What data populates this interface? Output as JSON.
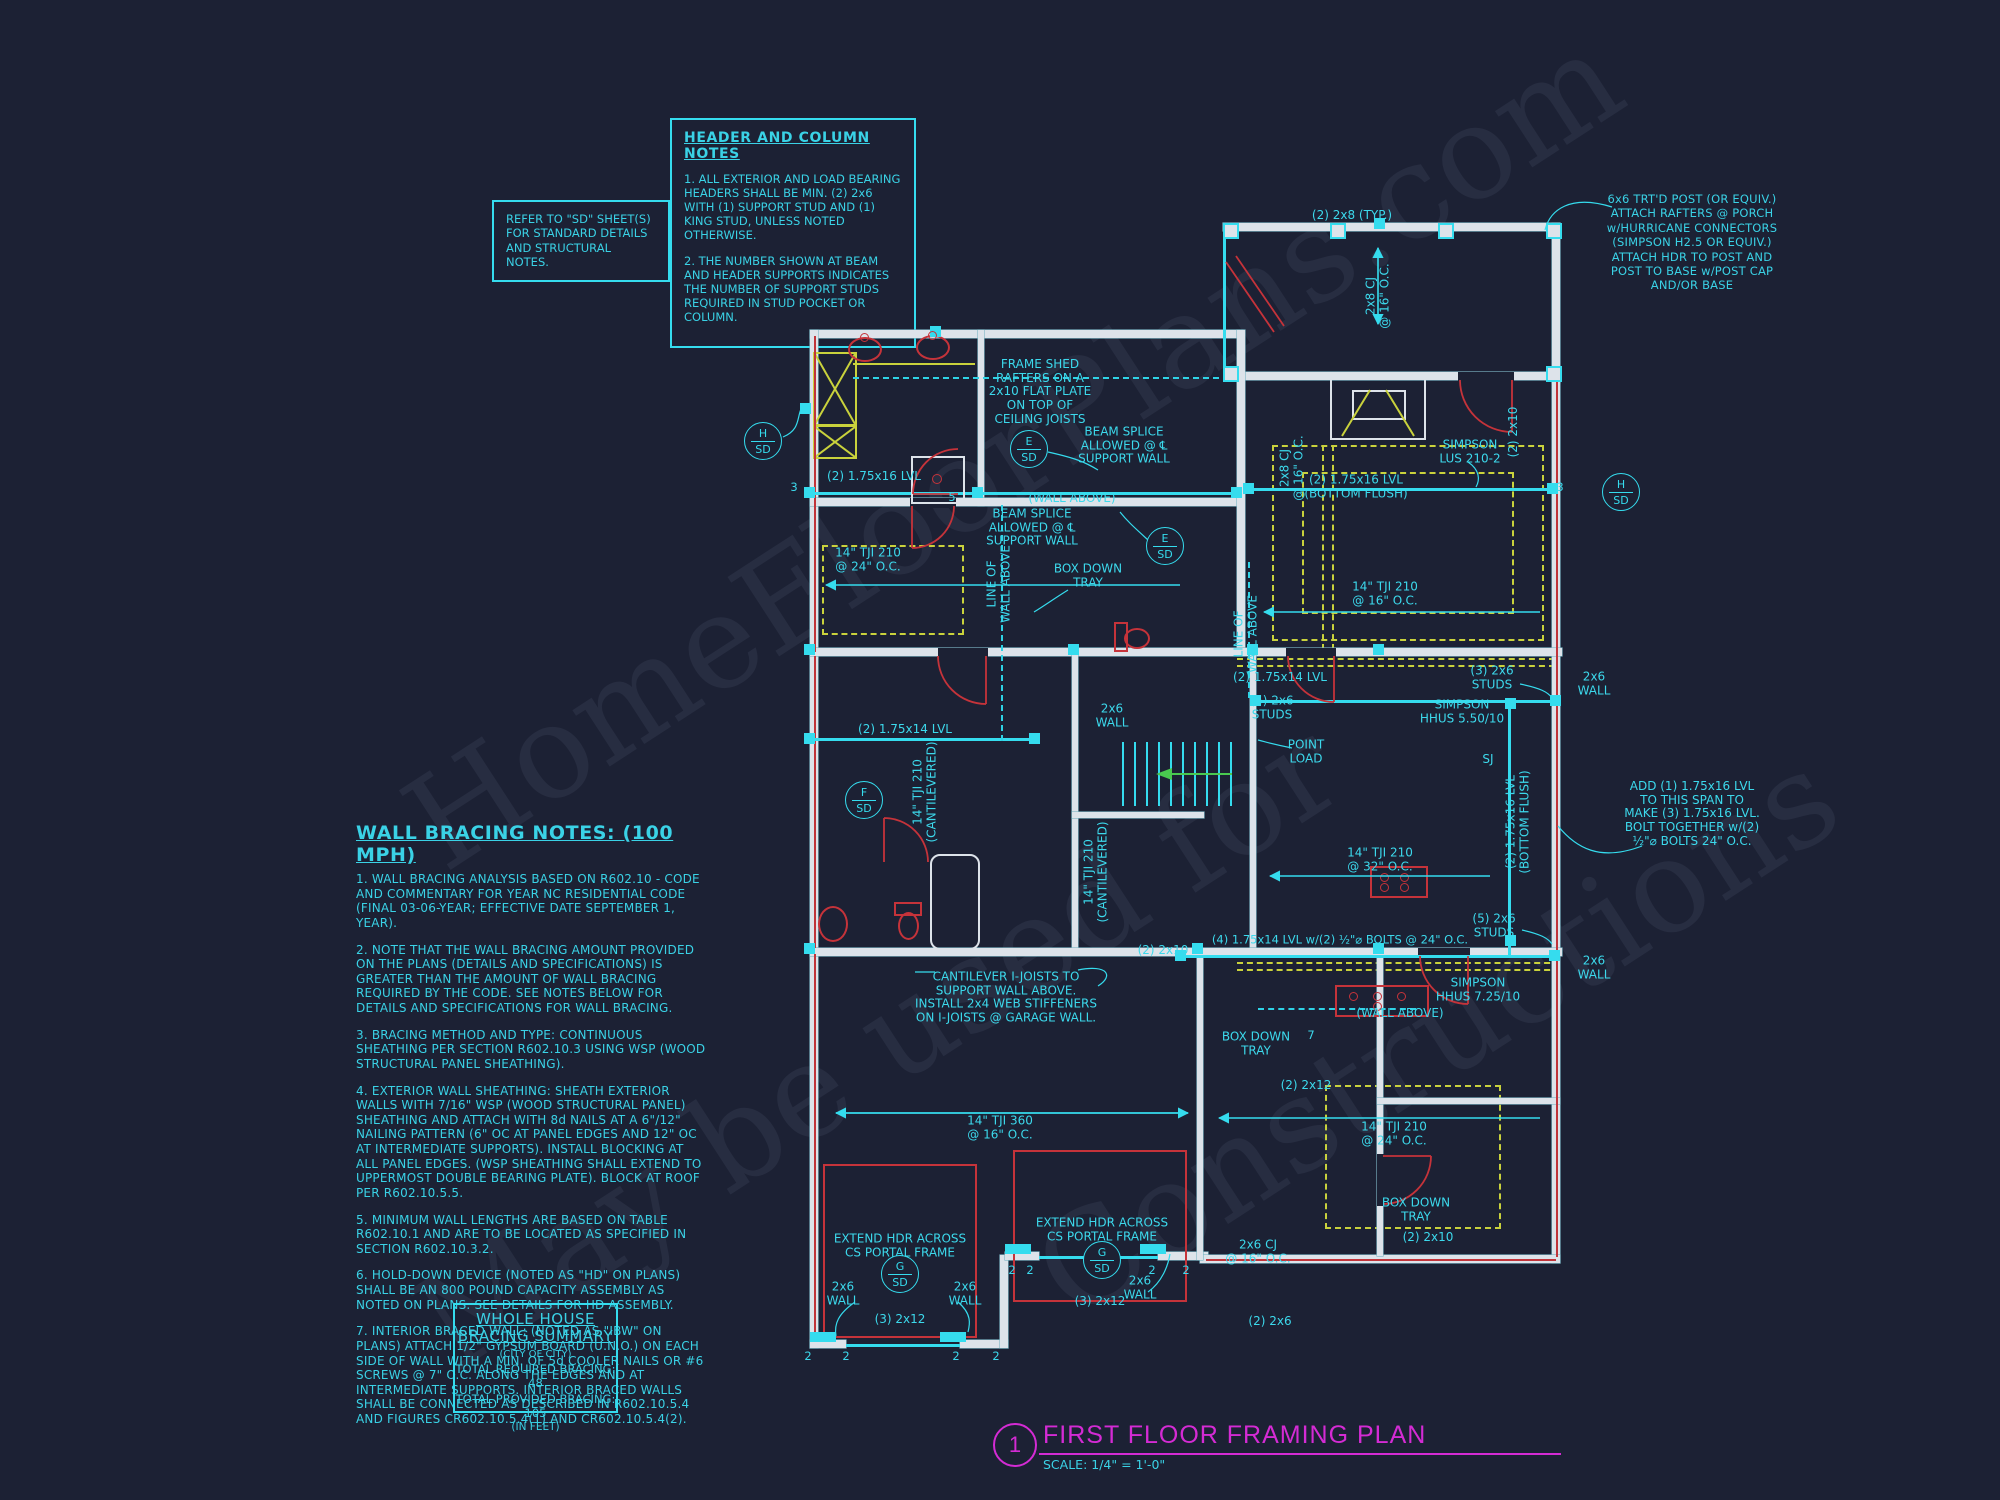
{
  "colors": {
    "background": "#1c2134",
    "cyan": "#35dcee",
    "yellow": "#c9d23c",
    "red": "#c5333a",
    "white_wall": "#dde3ea",
    "magenta": "#d42bd4"
  },
  "watermark": [
    "HomeFloorPlans.com",
    "May be used for",
    "Constructions"
  ],
  "notes": {
    "refer_box": "REFER TO \"SD\" SHEET(S)\nFOR STANDARD DETAILS\nAND STRUCTURAL NOTES.",
    "header_notes": {
      "title": "HEADER AND COLUMN NOTES",
      "items": [
        "1. ALL EXTERIOR AND LOAD BEARING HEADERS SHALL BE MIN. (2) 2x6 WITH (1) SUPPORT STUD AND (1) KING STUD, UNLESS NOTED OTHERWISE.",
        "2. THE NUMBER SHOWN AT BEAM AND HEADER SUPPORTS INDICATES THE NUMBER OF SUPPORT STUDS REQUIRED IN STUD POCKET OR COLUMN."
      ]
    },
    "post_note": "6x6 TRT'D POST (OR EQUIV.)\nATTACH RAFTERS @ PORCH\nw/HURRICANE CONNECTORS\n(SIMPSON H2.5 OR EQUIV.)\nATTACH HDR TO POST AND\nPOST TO BASE w/POST CAP\nAND/OR BASE",
    "wall_bracing": {
      "title": "WALL BRACING NOTES: (100 MPH)",
      "items": [
        "1. WALL BRACING ANALYSIS BASED ON R602.10 - CODE AND COMMENTARY FOR YEAR NC RESIDENTIAL CODE (FINAL 03-06-YEAR; EFFECTIVE DATE SEPTEMBER 1, YEAR).",
        "2. NOTE THAT THE WALL BRACING AMOUNT PROVIDED ON THE PLANS (DETAILS AND SPECIFICATIONS) IS GREATER THAN THE AMOUNT OF WALL BRACING REQUIRED BY THE CODE. SEE NOTES BELOW FOR DETAILS AND SPECIFICATIONS FOR WALL BRACING.",
        "3. BRACING METHOD AND TYPE: CONTINUOUS SHEATHING PER SECTION R602.10.3 USING WSP (WOOD STRUCTURAL PANEL SHEATHING).",
        "4. EXTERIOR WALL SHEATHING: SHEATH EXTERIOR WALLS WITH 7/16\" WSP (WOOD STRUCTURAL PANEL) SHEATHING AND ATTACH WITH 8d NAILS AT A 6\"/12\" NAILING PATTERN (6\" OC AT PANEL EDGES AND 12\" OC AT INTERMEDIATE SUPPORTS). INSTALL BLOCKING AT ALL PANEL EDGES. (WSP SHEATHING SHALL EXTEND TO UPPERMOST DOUBLE BEARING PLATE). BLOCK AT ROOF PER R602.10.5.5.",
        "5. MINIMUM WALL LENGTHS ARE BASED ON TABLE R602.10.1 AND ARE TO BE LOCATED AS SPECIFIED IN SECTION R602.10.3.2.",
        "6. HOLD-DOWN DEVICE (NOTED AS \"HD\" ON PLANS) SHALL BE AN 800 POUND CAPACITY ASSEMBLY AS NOTED ON PLANS. SEE DETAILS FOR HD ASSEMBLY.",
        "7. INTERIOR BRACED WALL: (NOTED AS \"IBW\" ON PLANS) ATTACH 1/2\" GYPSUM BOARD (U.N.O.) ON EACH SIDE OF WALL WITH A MIN. OF 5d COOLER NAILS OR #6 SCREWS @ 7\" O.C. ALONG THE EDGES AND AT INTERMEDIATE SUPPORTS.  INTERIOR BRACED WALLS SHALL BE CONNECTED AS DESCRIBED IN R602.10.5.4 AND FIGURES CR602.10.5.4(1) AND CR602.10.5.4(2)."
      ]
    },
    "summary": {
      "title_line1": "WHOLE HOUSE",
      "title_line2": "BRACING SUMMARY",
      "city": "(CITY OF CITY)",
      "required": "TOTAL REQUIRED BRACING: 48",
      "provided": "TOTAL PROVIDED BRACING: 105",
      "units": "(IN FEET)"
    }
  },
  "title_block": {
    "number": "1",
    "title": "FIRST FLOOR FRAMING PLAN",
    "scale": "SCALE: 1/4\" = 1'-0\""
  },
  "plan": {
    "labels": [
      {
        "t": "(2) 2x8 (TYP.)",
        "x": 1352,
        "y": 216
      },
      {
        "t": "2x8 CJ\n@ 16\" O.C.",
        "x": 1378,
        "y": 296,
        "rot": 1
      },
      {
        "t": "2x8 CJ\n@ 16\" O.C.",
        "x": 1292,
        "y": 468,
        "rot": 1
      },
      {
        "t": "FRAME SHED\nRAFTERS ON A\n2x10 FLAT PLATE\nON TOP OF\nCEILING JOISTS",
        "x": 1040,
        "y": 392
      },
      {
        "t": "BEAM SPLICE\nALLOWED @ ℄\nSUPPORT WALL",
        "x": 1124,
        "y": 446
      },
      {
        "t": "BEAM SPLICE\nALLOWED @ ℄\nSUPPORT WALL",
        "x": 1032,
        "y": 528
      },
      {
        "t": "(2) 1.75x16 LVL",
        "x": 874,
        "y": 477
      },
      {
        "t": "(WALL ABOVE)",
        "x": 1072,
        "y": 499
      },
      {
        "t": "(2) 1.75x16 LVL\n(BOTTOM FLUSH)",
        "x": 1356,
        "y": 487
      },
      {
        "t": "SIMPSON\nLUS 210-2",
        "x": 1470,
        "y": 452
      },
      {
        "t": "(2) 2x10",
        "x": 1514,
        "y": 432,
        "rot": 1
      },
      {
        "t": "14\" TJI 210\n@ 24\" O.C.",
        "x": 868,
        "y": 560
      },
      {
        "t": "BOX DOWN\nTRAY",
        "x": 1088,
        "y": 576
      },
      {
        "t": "LINE OF\nWALL ABOVE",
        "x": 999,
        "y": 584,
        "rot": 1
      },
      {
        "t": "14\" TJI 210\n@ 16\" O.C.",
        "x": 1385,
        "y": 594
      },
      {
        "t": "LINE OF\nWALL ABOVE",
        "x": 1246,
        "y": 634,
        "rot": 1
      },
      {
        "t": "(2) 1.75x14 LVL",
        "x": 1280,
        "y": 678
      },
      {
        "t": "(5) 2x6\nSTUDS",
        "x": 1272,
        "y": 708
      },
      {
        "t": "SIMPSON\nHHUS 5.50/10",
        "x": 1462,
        "y": 712
      },
      {
        "t": "(3) 2x6\nSTUDS",
        "x": 1492,
        "y": 678
      },
      {
        "t": "2x6\nWALL",
        "x": 1594,
        "y": 684
      },
      {
        "t": "(2) 1.75x14 LVL",
        "x": 905,
        "y": 730
      },
      {
        "t": "2x6\nWALL",
        "x": 1112,
        "y": 716
      },
      {
        "t": "POINT\nLOAD",
        "x": 1306,
        "y": 752
      },
      {
        "t": "14\" TJI 210\n(CANTILEVERED)",
        "x": 925,
        "y": 792,
        "rot": 1
      },
      {
        "t": "SJ",
        "x": 1488,
        "y": 760
      },
      {
        "t": "ADD (1) 1.75x16 LVL\nTO THIS SPAN TO\nMAKE (3) 1.75x16 LVL.\nBOLT TOGETHER w/(2)\n½\"⌀ BOLTS 24\" O.C.",
        "x": 1692,
        "y": 814
      },
      {
        "t": "(2) 1.75x16 LVL\n(BOTTOM FLUSH)",
        "x": 1518,
        "y": 822,
        "rot": 1
      },
      {
        "t": "14\" TJI 210\n@ 32\" O.C.",
        "x": 1380,
        "y": 860
      },
      {
        "t": "14\" TJI 210\n(CANTILEVERED)",
        "x": 1096,
        "y": 872,
        "rot": 1
      },
      {
        "t": "(5) 2x6\nSTUDS",
        "x": 1494,
        "y": 926
      },
      {
        "t": "(4) 1.75x14 LVL w/(2) ½\"⌀ BOLTS @ 24\" O.C.",
        "x": 1340,
        "y": 940,
        "size": 11.5
      },
      {
        "t": "(2) 2x10",
        "x": 1163,
        "y": 951
      },
      {
        "t": "2x6\nWALL",
        "x": 1594,
        "y": 968
      },
      {
        "t": "CANTILEVER I-JOISTS TO\nSUPPORT WALL ABOVE.\nINSTALL 2x4 WEB STIFFENERS\nON I-JOISTS @ GARAGE WALL.",
        "x": 1006,
        "y": 998
      },
      {
        "t": "SIMPSON\nHHUS 7.25/10",
        "x": 1478,
        "y": 990
      },
      {
        "t": "(WALL ABOVE)",
        "x": 1400,
        "y": 1014
      },
      {
        "t": "BOX DOWN\nTRAY",
        "x": 1256,
        "y": 1044
      },
      {
        "t": "(2) 2x12",
        "x": 1306,
        "y": 1086
      },
      {
        "t": "14\" TJI 210\n@ 24\" O.C.",
        "x": 1394,
        "y": 1134
      },
      {
        "t": "14\" TJI 360\n@ 16\" O.C.",
        "x": 1000,
        "y": 1128
      },
      {
        "t": "BOX DOWN\nTRAY",
        "x": 1416,
        "y": 1210
      },
      {
        "t": "2x6 CJ\n@ 16\" O.C.",
        "x": 1258,
        "y": 1252
      },
      {
        "t": "(2) 2x10",
        "x": 1428,
        "y": 1238
      },
      {
        "t": "(2) 2x6",
        "x": 1270,
        "y": 1322
      },
      {
        "t": "EXTEND HDR ACROSS\nCS PORTAL FRAME",
        "x": 900,
        "y": 1246
      },
      {
        "t": "EXTEND HDR ACROSS\nCS PORTAL FRAME",
        "x": 1102,
        "y": 1230
      },
      {
        "t": "2x6\nWALL",
        "x": 843,
        "y": 1294
      },
      {
        "t": "2x6\nWALL",
        "x": 965,
        "y": 1294
      },
      {
        "t": "2x6\nWALL",
        "x": 1140,
        "y": 1288
      },
      {
        "t": "(3) 2x12",
        "x": 900,
        "y": 1320
      },
      {
        "t": "(3) 2x12",
        "x": 1100,
        "y": 1302
      }
    ],
    "stud_numbers": [
      {
        "t": "3",
        "x": 794,
        "y": 487
      },
      {
        "t": "5",
        "x": 952,
        "y": 497
      },
      {
        "t": "3",
        "x": 1560,
        "y": 487
      },
      {
        "t": "7",
        "x": 1311,
        "y": 1035
      },
      {
        "t": "2",
        "x": 808,
        "y": 1356
      },
      {
        "t": "2",
        "x": 846,
        "y": 1356
      },
      {
        "t": "2",
        "x": 956,
        "y": 1356
      },
      {
        "t": "2",
        "x": 996,
        "y": 1356
      },
      {
        "t": "2",
        "x": 1012,
        "y": 1270
      },
      {
        "t": "2",
        "x": 1030,
        "y": 1270
      },
      {
        "t": "2",
        "x": 1152,
        "y": 1270
      },
      {
        "t": "2",
        "x": 1186,
        "y": 1270
      }
    ],
    "detail_markers": [
      {
        "top": "H",
        "bottom": "SD",
        "x": 763,
        "y": 441
      },
      {
        "top": "E",
        "bottom": "SD",
        "x": 1029,
        "y": 449
      },
      {
        "top": "E",
        "bottom": "SD",
        "x": 1165,
        "y": 546
      },
      {
        "top": "H",
        "bottom": "SD",
        "x": 1621,
        "y": 492
      },
      {
        "top": "F",
        "bottom": "SD",
        "x": 864,
        "y": 800
      },
      {
        "top": "G",
        "bottom": "SD",
        "x": 900,
        "y": 1274
      },
      {
        "top": "G",
        "bottom": "SD",
        "x": 1102,
        "y": 1260
      }
    ]
  }
}
